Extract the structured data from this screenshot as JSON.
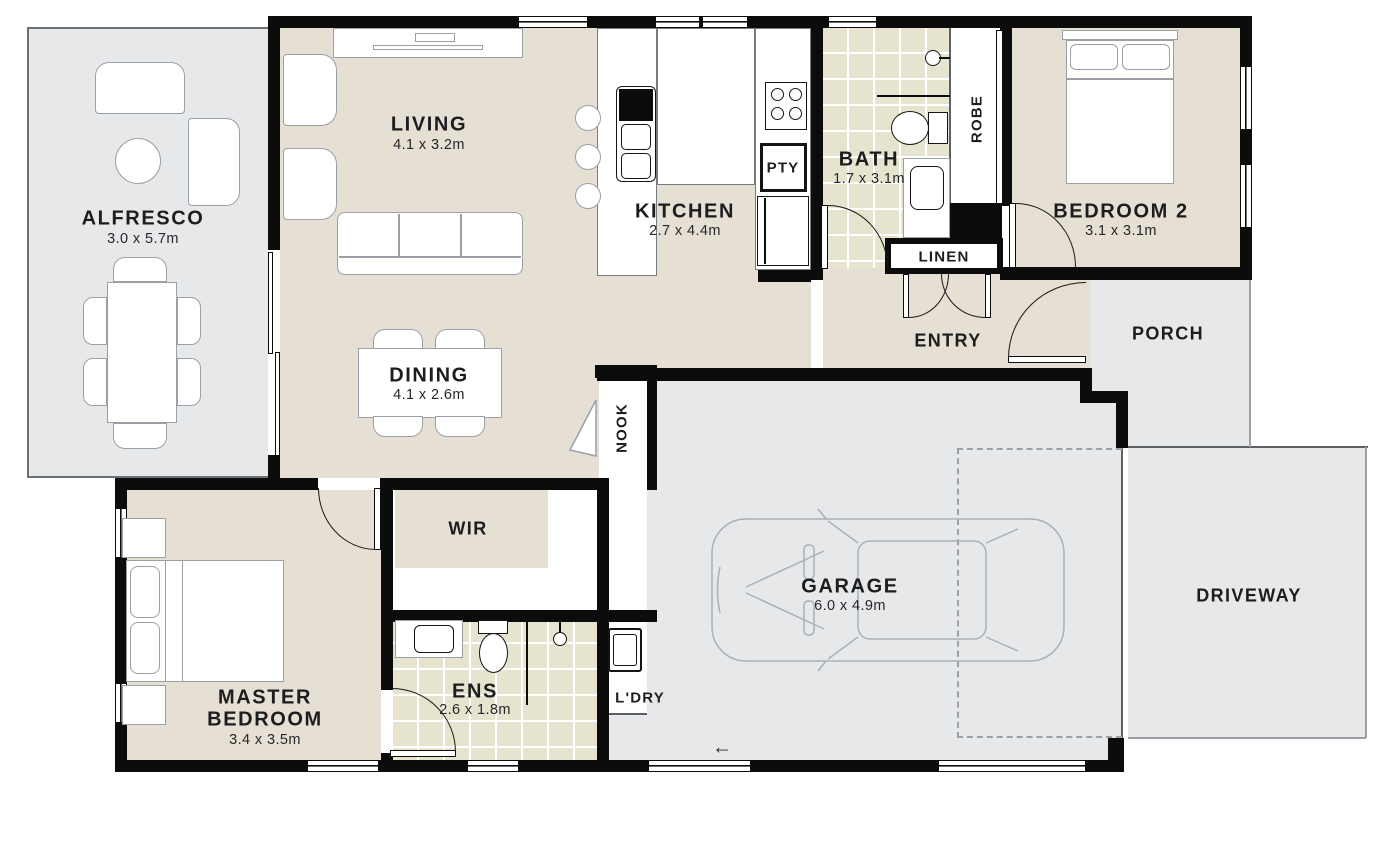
{
  "plan_title": "Residential floor plan",
  "rooms": {
    "alfresco": {
      "name": "ALFRESCO",
      "dims": "3.0 x 5.7m"
    },
    "living": {
      "name": "LIVING",
      "dims": "4.1 x 3.2m"
    },
    "kitchen": {
      "name": "KITCHEN",
      "dims": "2.7 x 4.4m"
    },
    "bath": {
      "name": "BATH",
      "dims": "1.7 x 3.1m"
    },
    "bedroom2": {
      "name": "BEDROOM 2",
      "dims": "3.1 x 3.1m"
    },
    "dining": {
      "name": "DINING",
      "dims": "4.1 x 2.6m"
    },
    "master": {
      "name_line1": "MASTER",
      "name_line2": "BEDROOM",
      "dims": "3.4 x 3.5m"
    },
    "ens": {
      "name": "ENS",
      "dims": "2.6 x 1.8m"
    },
    "garage": {
      "name": "GARAGE",
      "dims": "6.0 x 4.9m"
    },
    "entry": {
      "name": "ENTRY"
    },
    "porch": {
      "name": "PORCH"
    },
    "driveway": {
      "name": "DRIVEWAY"
    },
    "wir": {
      "name": "WIR"
    },
    "nook": {
      "name": "NOOK"
    },
    "robe": {
      "name": "ROBE"
    },
    "linen": {
      "name": "LINEN"
    },
    "pantry": {
      "name": "PTY"
    },
    "laundry": {
      "name": "L'DRY"
    }
  },
  "symbols": {
    "garage_entry_arrow": "←"
  },
  "colors": {
    "wall": "#0c0c0c",
    "interior_floor": "#e5dfd4",
    "tile_floor": "#e6e4ce",
    "outdoor_concrete": "#e7e8ea",
    "furniture_line": "#9aa0a5",
    "text": "#1c1d1f"
  }
}
